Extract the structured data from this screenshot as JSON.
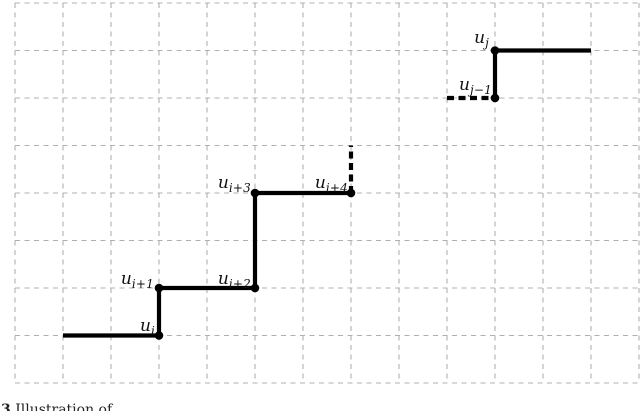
{
  "figure": {
    "type": "step-function-diagram",
    "background": "#ffffff",
    "grid": {
      "color": "#b0b0b0",
      "line_width": 1.1,
      "dash": "5 4.5",
      "x_lines": [
        15,
        63,
        111,
        159,
        207,
        255,
        303,
        351,
        399,
        447,
        495,
        543,
        591,
        639
      ],
      "y_lines": [
        3,
        50.5,
        98,
        145.5,
        193,
        240.5,
        288,
        335.5,
        383
      ],
      "x_extent": [
        15,
        639
      ],
      "y_extent": [
        3,
        383
      ]
    },
    "stroke": {
      "color": "#000000",
      "width": 4.2,
      "dash": "7 4.5"
    },
    "solid_paths": [
      "M 63 335.5 H 159 V 288 H 255 V 193 H 351",
      "M 495 98 V 50.5 H 591"
    ],
    "dashed_lines": [
      {
        "x1": 351,
        "y1": 193,
        "x2": 351,
        "y2": 145.5
      },
      {
        "x1": 447,
        "y1": 98,
        "x2": 495,
        "y2": 98
      }
    ],
    "dots": {
      "radius": 4.3,
      "color": "#000000",
      "points": [
        [
          159,
          335.5
        ],
        [
          159,
          288
        ],
        [
          255,
          288
        ],
        [
          255,
          193
        ],
        [
          351,
          193
        ],
        [
          495,
          98
        ],
        [
          495,
          50.5
        ]
      ]
    },
    "labels": [
      {
        "id": "u-i",
        "base": "u",
        "sub": "i",
        "right": 155,
        "bottom": 335
      },
      {
        "id": "u-i-plus-1",
        "base": "u",
        "sub": "i+1",
        "right": 154,
        "bottom": 288
      },
      {
        "id": "u-i-plus-2",
        "base": "u",
        "sub": "i+2",
        "right": 251,
        "bottom": 288
      },
      {
        "id": "u-i-plus-3",
        "base": "u",
        "sub": "i+3",
        "right": 251,
        "bottom": 192
      },
      {
        "id": "u-i-plus-4",
        "base": "u",
        "sub": "i+4",
        "right": 348,
        "bottom": 192
      },
      {
        "id": "u-j-minus-1",
        "base": "u",
        "sub": "j−1",
        "right": 492,
        "bottom": 94
      },
      {
        "id": "u-j",
        "base": "u",
        "sub": "j",
        "right": 489,
        "bottom": 47
      }
    ]
  },
  "caption": {
    "number": "3",
    "text": "Illustration of"
  }
}
